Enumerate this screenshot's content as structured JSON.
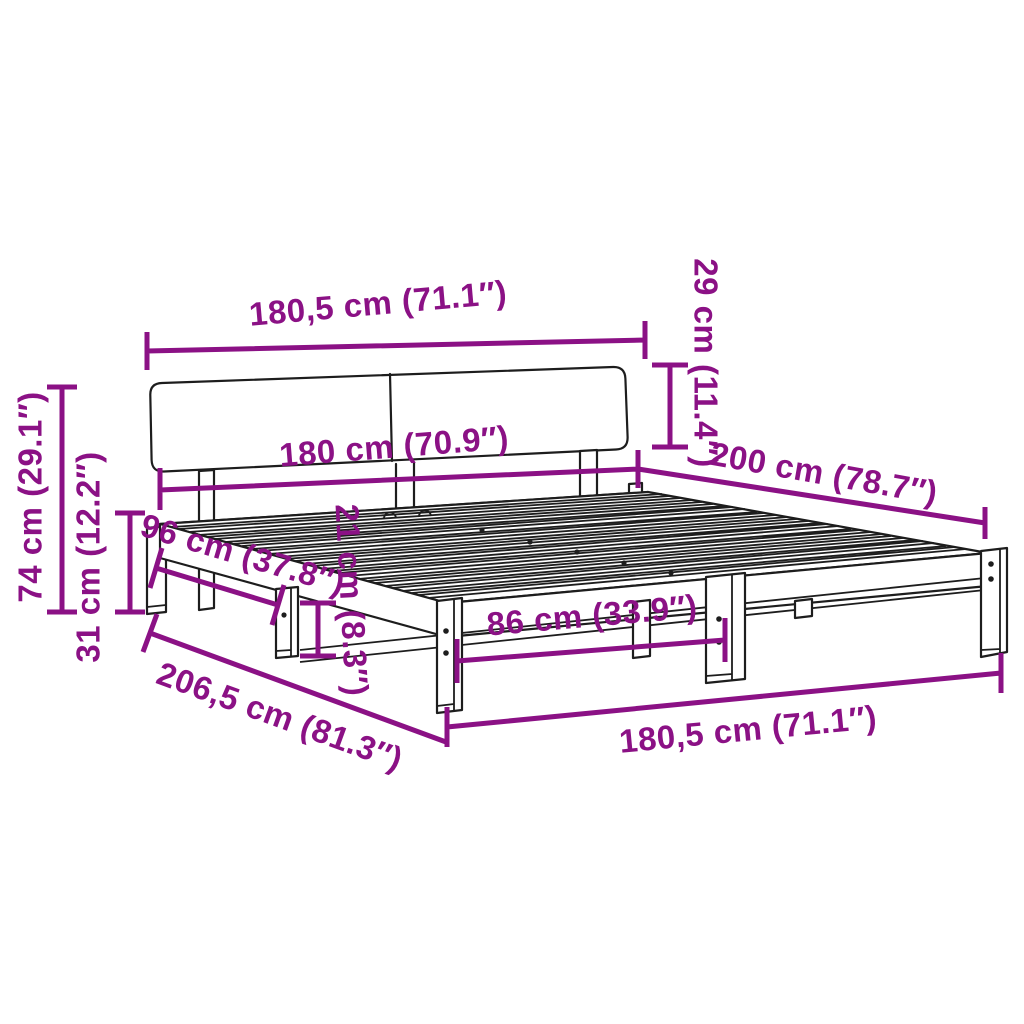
{
  "diagram": {
    "subject": "bed-frame-with-headboard-dimension-diagram",
    "colors": {
      "dimension_accent": "#8B1185",
      "line_art": "#1D1D1D",
      "background": "#FFFFFF"
    }
  },
  "dims": {
    "top_width": "180,5 cm (71.1″)",
    "headboard_height": "29 cm (11.4″)",
    "inner_width": "180 cm (70.9″)",
    "length_right": "200 cm (78.7″)",
    "side_offset": "96 cm (37.8″)",
    "under_clearance": "21 cm (8.3″)",
    "leg_spacing": "86 cm (33.9″)",
    "bottom_width": "180,5 cm (71.1″)",
    "total_length": "206,5 cm (81.3″)",
    "total_height": "74 cm (29.1″)",
    "base_height": "31 cm (12.2″)"
  }
}
